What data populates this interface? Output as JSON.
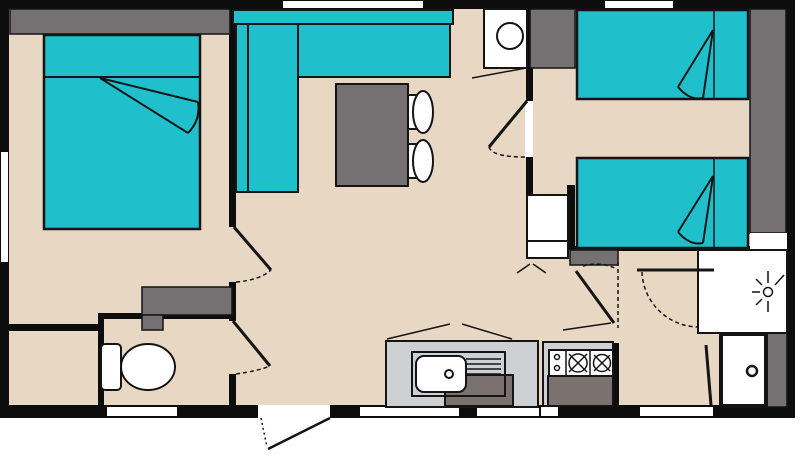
{
  "diagram": {
    "type": "floor-plan",
    "colors": {
      "background": "#ffffff",
      "wall": "#0d0d0d",
      "floor": "#e8d7c3",
      "teal": "#1fc0cb",
      "gray": "#757072",
      "counter": "#cdd1d3",
      "front": "#7b716e",
      "white": "#ffffff"
    },
    "symbols": [
      "double-bed",
      "single-bed",
      "corner-sofa",
      "dining-table",
      "stool",
      "toilet",
      "wardrobe",
      "dresser",
      "water-heater",
      "storage-cabinet",
      "kitchen-sink",
      "hob",
      "kitchen-counter",
      "shower",
      "washbasin",
      "door-swing",
      "window"
    ]
  }
}
